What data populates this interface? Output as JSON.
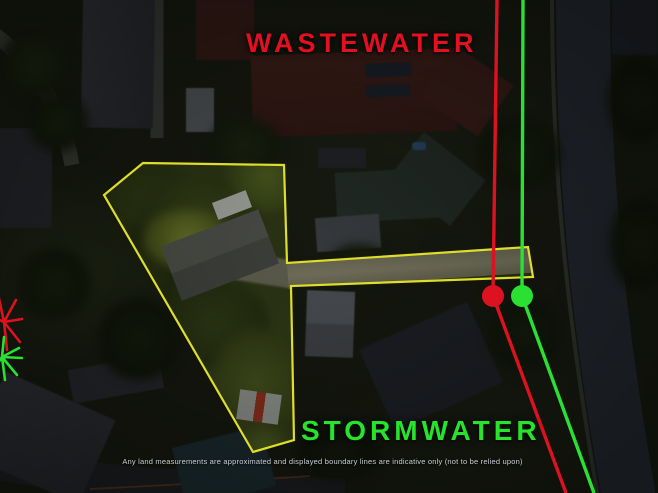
{
  "labels": {
    "wastewater": "WASTEWATER",
    "stormwater": "STORMWATER",
    "disclaimer": "Any land measurements are approximated and displayed boundary lines are indicative only (not to be relied upon)"
  },
  "colors": {
    "wastewater": "#dc1220",
    "stormwater": "#2ae032",
    "boundary": "#dede2a"
  },
  "overlay": {
    "parcel_points": "143,163 284,165 287,263 528,247 533,277 291,286 294,440 253,452 104,195",
    "wastewater_line_points": "497,0 493,296 566,493",
    "stormwater_line_points": "523,0 522,296 594,493",
    "wastewater_node": {
      "x": 493,
      "y": 296,
      "r": 11
    },
    "stormwater_node": {
      "x": 522,
      "y": 296,
      "r": 11
    },
    "wastewater_junction_path": "M4,322 L16,300 M4,322 L22,319 M4,322 L20,342 M4,322 L7,350 M4,322 L-2,294 M4,322 L-10,316",
    "stormwater_junction_path": "M2,357 L19,348 M2,357 L22,358 M2,357 L17,375 M2,357 L5,380 M2,357 L4,337 M2,357 L-8,372"
  }
}
